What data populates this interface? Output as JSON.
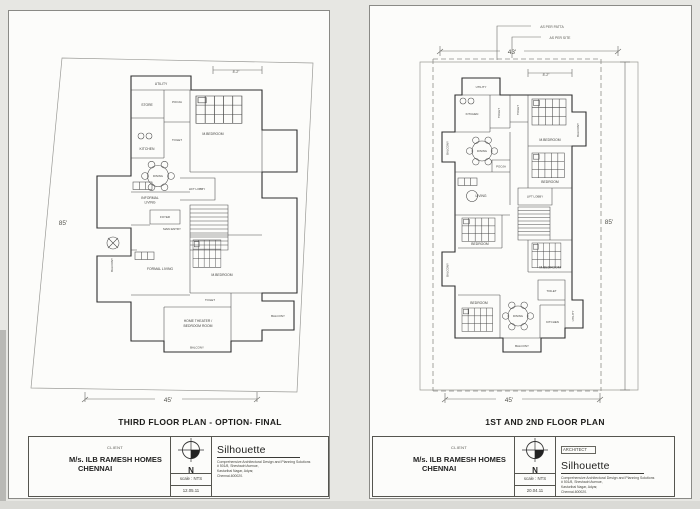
{
  "left_sheet": {
    "plan_title": "THIRD FLOOR PLAN - OPTION- FINAL",
    "dims": {
      "side": "85'",
      "bottom": "45'",
      "d1": "8'-2\""
    },
    "rooms": {
      "utility": "UTILITY",
      "store": "STORE",
      "kitchen": "KITCHEN",
      "pooja": "POOJA",
      "toilet_top": "TOILET",
      "mbed_top": "M.BEDROOM",
      "dining": "DINING",
      "informal_1": "INFORMAL",
      "informal_2": "LIVING",
      "lift_lobby": "LIFT LOBBY",
      "foyer": "FOYER",
      "main_entry": "MAIN ENTRY",
      "balcony_left": "BALCONY",
      "formal_living": "FORMAL LIVING",
      "mbed_bottom": "M.BEDROOM",
      "toilet_bottom": "TOILET",
      "home_1": "HOME THEATER /",
      "home_2": "BEDROOM ROOM",
      "balcony_bottom": "BALCONY",
      "balcony_right": "BALCONY"
    },
    "title_block": {
      "client_label": "CLIENT",
      "client_name": "M/s. ILB RAMESH HOMES",
      "client_city": "CHENNAI",
      "north": "N",
      "scale": "scale : NTS",
      "date": "12.05.11",
      "firm": "Silhouette",
      "tagline": "Comprehensive Architectural Design and Planning Solutions",
      "addr1": "# 501/8, Sheshadri Avenue,",
      "addr2": "Kasturibai Nagar, Adyar,",
      "addr3": "Chennai-600020."
    }
  },
  "right_sheet": {
    "plan_title": "1ST AND 2ND FLOOR PLAN",
    "dims": {
      "side": "85'",
      "top": "43'",
      "bottom": "45'",
      "d1": "8'-2\""
    },
    "notes": {
      "patta": "AS PER PATTA",
      "site": "AS PER SITE"
    },
    "architect_label": "ARCHITECT",
    "rooms": {
      "utility_top": "UTILITY",
      "kitchen_top": "KITCHEN",
      "toilet_a": "TOILET",
      "toilet_b": "TOILET",
      "mbed_top": "M.BEDROOM",
      "balcony_right_top": "BALCONY",
      "balcony_left_top": "BALCONY",
      "dining_top": "DINING",
      "pooja": "POOJA",
      "bedroom_mid": "BEDROOM",
      "lift_lobby": "LIFT LOBBY",
      "living": "LIVING",
      "bedroom_left": "BEDROOM",
      "mbed_right": "M.BEDROOM",
      "balcony_left_mid": "BALCONY",
      "toilet_c": "TOILET",
      "bedroom_bottom": "BEDROOM",
      "dining_bottom": "DINING",
      "kitchen_bottom": "KITCHEN",
      "utility_bottom": "UTILITY",
      "balcony_bottom": "BALCONY"
    },
    "title_block": {
      "client_label": "CLIENT",
      "client_name": "M/s. ILB RAMESH HOMES",
      "client_city": "CHENNAI",
      "north": "N",
      "scale": "scale : NTS",
      "date": "20.04.11",
      "firm": "Silhouette",
      "tagline": "Comprehensive Architectural Design and Planning Solutions",
      "addr1": "# 501/8, Sheshadri Avenue,",
      "addr2": "Kasturibai Nagar, Adyar,",
      "addr3": "Chennai-600020."
    }
  }
}
